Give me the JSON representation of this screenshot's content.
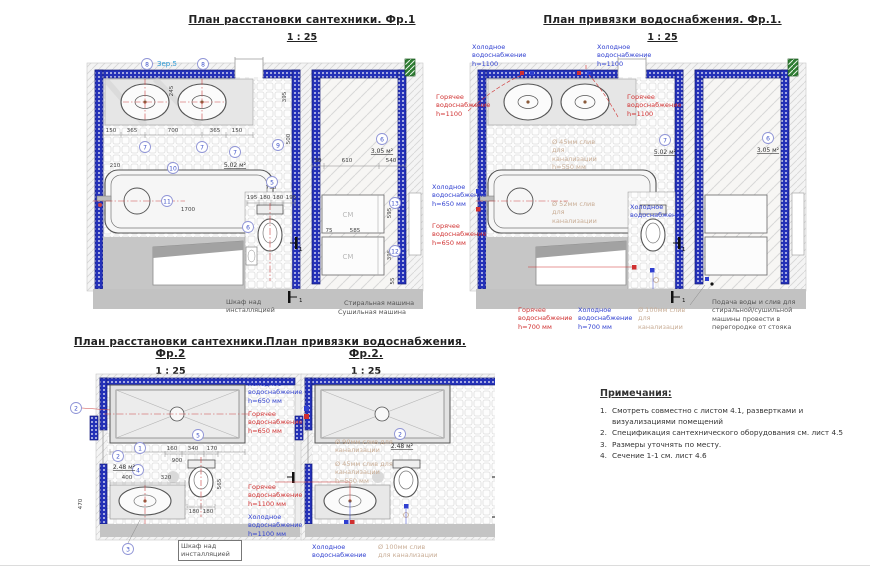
{
  "p1": {
    "title": "План расстановки сантехники. Фр.1",
    "scale": "1 : 25",
    "mirror": "Зер.5",
    "areas": {
      "bath": "5.02 м²",
      "laundry": "3.05 м²"
    },
    "tags": {
      "t8a": "8",
      "t8b": "8",
      "t10": "10",
      "t7a": "7",
      "t7b": "7",
      "t7c": "7",
      "t9": "9",
      "t5": "5",
      "t6": "6",
      "t11": "11",
      "t6b": "6",
      "t13": "13",
      "t12": "12"
    },
    "dims": [
      "150",
      "365",
      "700",
      "365",
      "150",
      "245",
      "395",
      "500",
      "1700",
      "210",
      "215",
      "750",
      "195",
      "180",
      "180",
      "195",
      "50",
      "610",
      "540",
      "75",
      "585",
      "595",
      "395",
      "55"
    ],
    "labels": {
      "cabinet": "Шкаф над инсталляцией",
      "washer": "Стиральная машина",
      "dryer": "Сушильная машина",
      "cm": "СМ",
      "sec": "1"
    }
  },
  "p2": {
    "title": "План привязки водоснабжения. Фр.1.",
    "scale": "1 : 25",
    "cold_top_l": "Холодное водоснабжение h=1100",
    "cold_top_m": "Холодное водоснабжение h=1100",
    "hot_l": "Горячее водоснабжение h=1100",
    "hot_m": "Горячее водоснабжение h=1100",
    "cold650": "Холодное водоснабжение h=650 мм",
    "hot650": "Горячее водоснабжение h=650 мм",
    "cold_wc": "Холодное водоснабжение",
    "hot700": "Горячее водоснабжение h=700 мм",
    "cold700": "Холодное водоснабжение h=700 мм",
    "drain45": "Ø 45мм слив для канализации h=550 мм",
    "drain52": "Ø 52мм слив для канализации",
    "drain100": "Ø 100мм слив для канализации",
    "machine_note": "Подача воды и слив для стиральной/сушильной машины провести в перегородке от стояка",
    "areas": {
      "bath": "5.02 м²",
      "laundry": "3.05 м²"
    },
    "tags": {
      "t7": "7",
      "t6": "6"
    },
    "labels": {
      "cm": "СМ",
      "sec": "1"
    }
  },
  "p3": {
    "title": "План расстановки сантехники. Фр.2",
    "scale": "1 : 25",
    "area": "2.48 м²",
    "tags": {
      "t2a": "2",
      "t2b": "2",
      "t1": "1",
      "t4": "4",
      "t5": "5",
      "t3": "3"
    },
    "dims": [
      "900",
      "400",
      "320",
      "470",
      "160",
      "340",
      "170",
      "180",
      "180",
      "565"
    ],
    "labels": {
      "cabinet": "Шкаф над инсталляцией",
      "sec": "1"
    }
  },
  "p4": {
    "title": "План привязки водоснабжения. Фр.2.",
    "scale": "1 : 25",
    "cold650": "Холодное водоснабжение h=650 мм",
    "hot650": "Горячее водоснабжение h=650 мм",
    "hot1100": "Горячее водоснабжение h=1100 мм",
    "cold1100": "Холодное водоснабжение h=1100 мм",
    "cold_btm": "Холодное водоснабжение",
    "drain90": "Ø 90мм слив для канализации",
    "drain45": "Ø 45мм слив для канализации h=550 мм",
    "drain100": "Ø 100мм слив для канализации",
    "area": "2.48 м²",
    "tags": {
      "t2": "2"
    },
    "labels": {
      "sec": "1"
    }
  },
  "notes": {
    "title": "Примечания:",
    "nums": [
      "1.",
      "2.",
      "3.",
      "4."
    ],
    "items": [
      "Смотреть совместно с листом 4.1, развертками и визуализациями помещений",
      "Спецификация сантехнического оборудования см. лист 4.5",
      "Размеры уточнять по месту.",
      "Сечение 1-1 см. лист 4.6"
    ]
  },
  "colors": {
    "wall": "#2431b8",
    "hot": "#d03030",
    "cold": "#2f3fd0",
    "drain_text": "#c9ae97",
    "green": "#2e7d32"
  }
}
